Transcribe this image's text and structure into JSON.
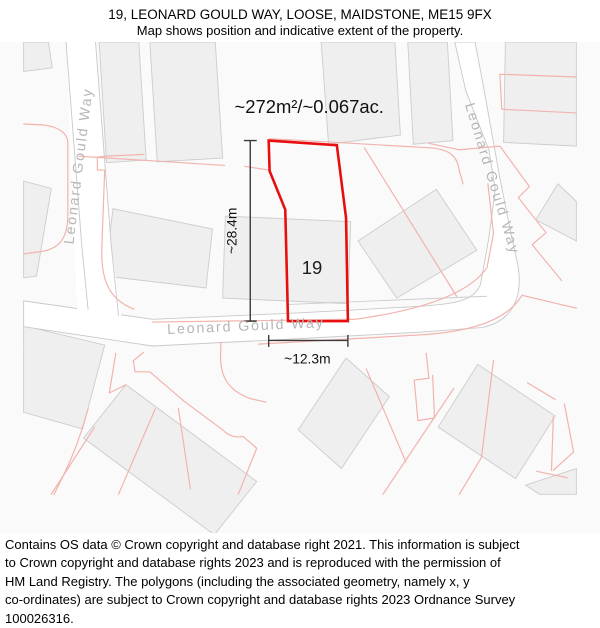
{
  "header": {
    "title": "19, LEONARD GOULD WAY, LOOSE, MAIDSTONE, ME15 9FX",
    "subtitle": "Map shows position and indicative extent of the property."
  },
  "map": {
    "area_label": "~272m²/~0.067ac.",
    "plot_number": "19",
    "dimension_vertical": "~28.4m",
    "dimension_horizontal": "~12.3m",
    "street_labels": {
      "left_road": "Leonard Gould Way",
      "center_road": "Leonard Gould Way",
      "right_road": "Leonard Gould Way"
    },
    "colors": {
      "plot_outline": "#e80e0e",
      "parcel_line": "#f2b3ae",
      "building_fill": "#efefef",
      "building_stroke": "#cdcdcd",
      "road_fill": "#ffffff",
      "road_stroke": "#c9c9c9",
      "street_label": "#b6b6b6",
      "dimension": "#3a3a3a"
    }
  },
  "footer": {
    "lines": [
      "Contains OS data © Crown copyright and database right 2021. This information is subject",
      "to Crown copyright and database rights 2023 and is reproduced with the permission of",
      "HM Land Registry. The polygons (including the associated geometry, namely x, y",
      "co-ordinates) are subject to Crown copyright and database rights 2023 Ordnance Survey",
      "100026316."
    ]
  }
}
